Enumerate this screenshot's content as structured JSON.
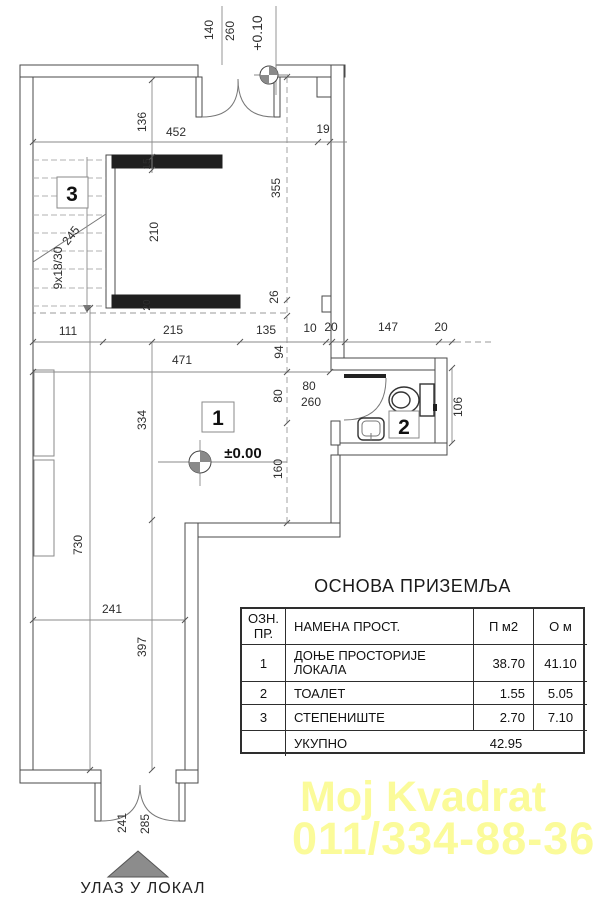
{
  "plan": {
    "dims": {
      "d140": "140",
      "d260": "260",
      "lvl_top": "+0.10",
      "d136": "136",
      "d452": "452",
      "d19": "19",
      "d15": "15",
      "d210": "210",
      "d20w": "20",
      "stair_steps": "9x18/30",
      "stair_run": "245",
      "d111": "111",
      "d215": "215",
      "d135": "135",
      "d10": "10",
      "d20a": "20",
      "d147": "147",
      "d20b": "20",
      "d471": "471",
      "d94": "94",
      "d355": "355",
      "d26": "26",
      "d80": "80",
      "d160": "160",
      "d334": "334",
      "d730": "730",
      "d397": "397",
      "d241": "241",
      "door80": "80",
      "door260": "260",
      "d106": "106",
      "d241b": "241",
      "d285b": "285",
      "lvl_zero": "±0.00"
    },
    "rooms": {
      "hall": "1",
      "toilet": "2",
      "stairs": "3"
    },
    "entrance_label": "УЛАЗ У ЛОКАЛ"
  },
  "legend": {
    "title": "ОСНОВА ПРИЗЕМЉА",
    "table": {
      "headers": {
        "col1": "ОЗН.\nПР.",
        "col2": "НАМЕНА ПРОСТ.",
        "col3": "П м2",
        "col4": "О м"
      },
      "rows": [
        {
          "id": "1",
          "name": "ДОЊЕ ПРОСТОРИЈЕ\nЛОКАЛА",
          "area": "38.70",
          "perimeter": "41.10"
        },
        {
          "id": "2",
          "name": "ТОАЛЕТ",
          "area": "1.55",
          "perimeter": "5.05"
        },
        {
          "id": "3",
          "name": "СТЕПЕНИШТЕ",
          "area": "2.70",
          "perimeter": "7.10"
        }
      ],
      "total": {
        "label": "УКУПНО",
        "area": "42.95"
      }
    }
  },
  "watermark": {
    "line1": "Moj Kvadrat",
    "line2": "011/334-88-36",
    "color": "#FBFB9A"
  }
}
